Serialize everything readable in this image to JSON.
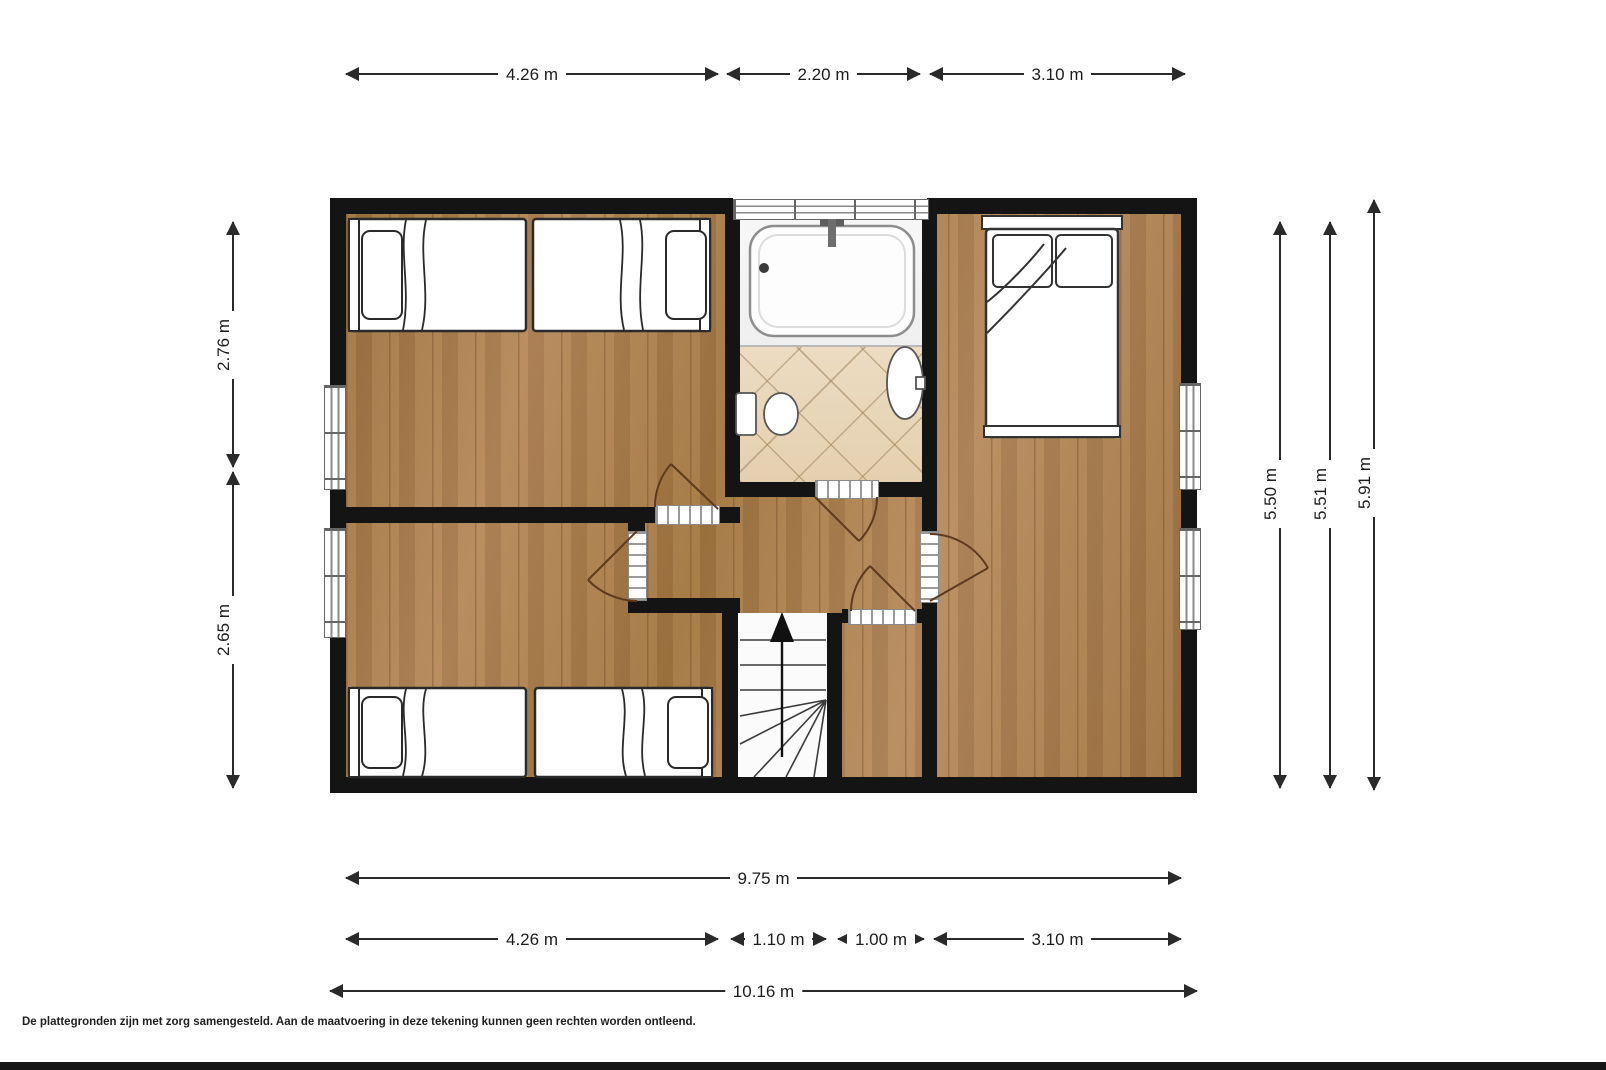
{
  "plan": {
    "footer_disclaimer": "De plattegronden zijn met zorg samengesteld.  Aan de maatvoering in deze tekening kunnen geen rechten worden ontleend.",
    "dimensions": {
      "top": [
        "4.26 m",
        "2.20 m",
        "3.10 m"
      ],
      "left": [
        "2.76 m",
        "2.65 m"
      ],
      "right": [
        "5.50 m",
        "5.51 m",
        "5.91 m"
      ],
      "bottom_inner_total": "9.75 m",
      "bottom_segments": [
        "4.26 m",
        "1.10 m",
        "1.00 m",
        "3.10 m"
      ],
      "bottom_outer_total": "10.16 m"
    },
    "colors": {
      "wall": "#141414",
      "wood_floor": "#aa7e50",
      "tile_floor": "#ead9bd",
      "dimension_line": "#2a2a2a",
      "door_arc": "#5e3a1e"
    }
  }
}
